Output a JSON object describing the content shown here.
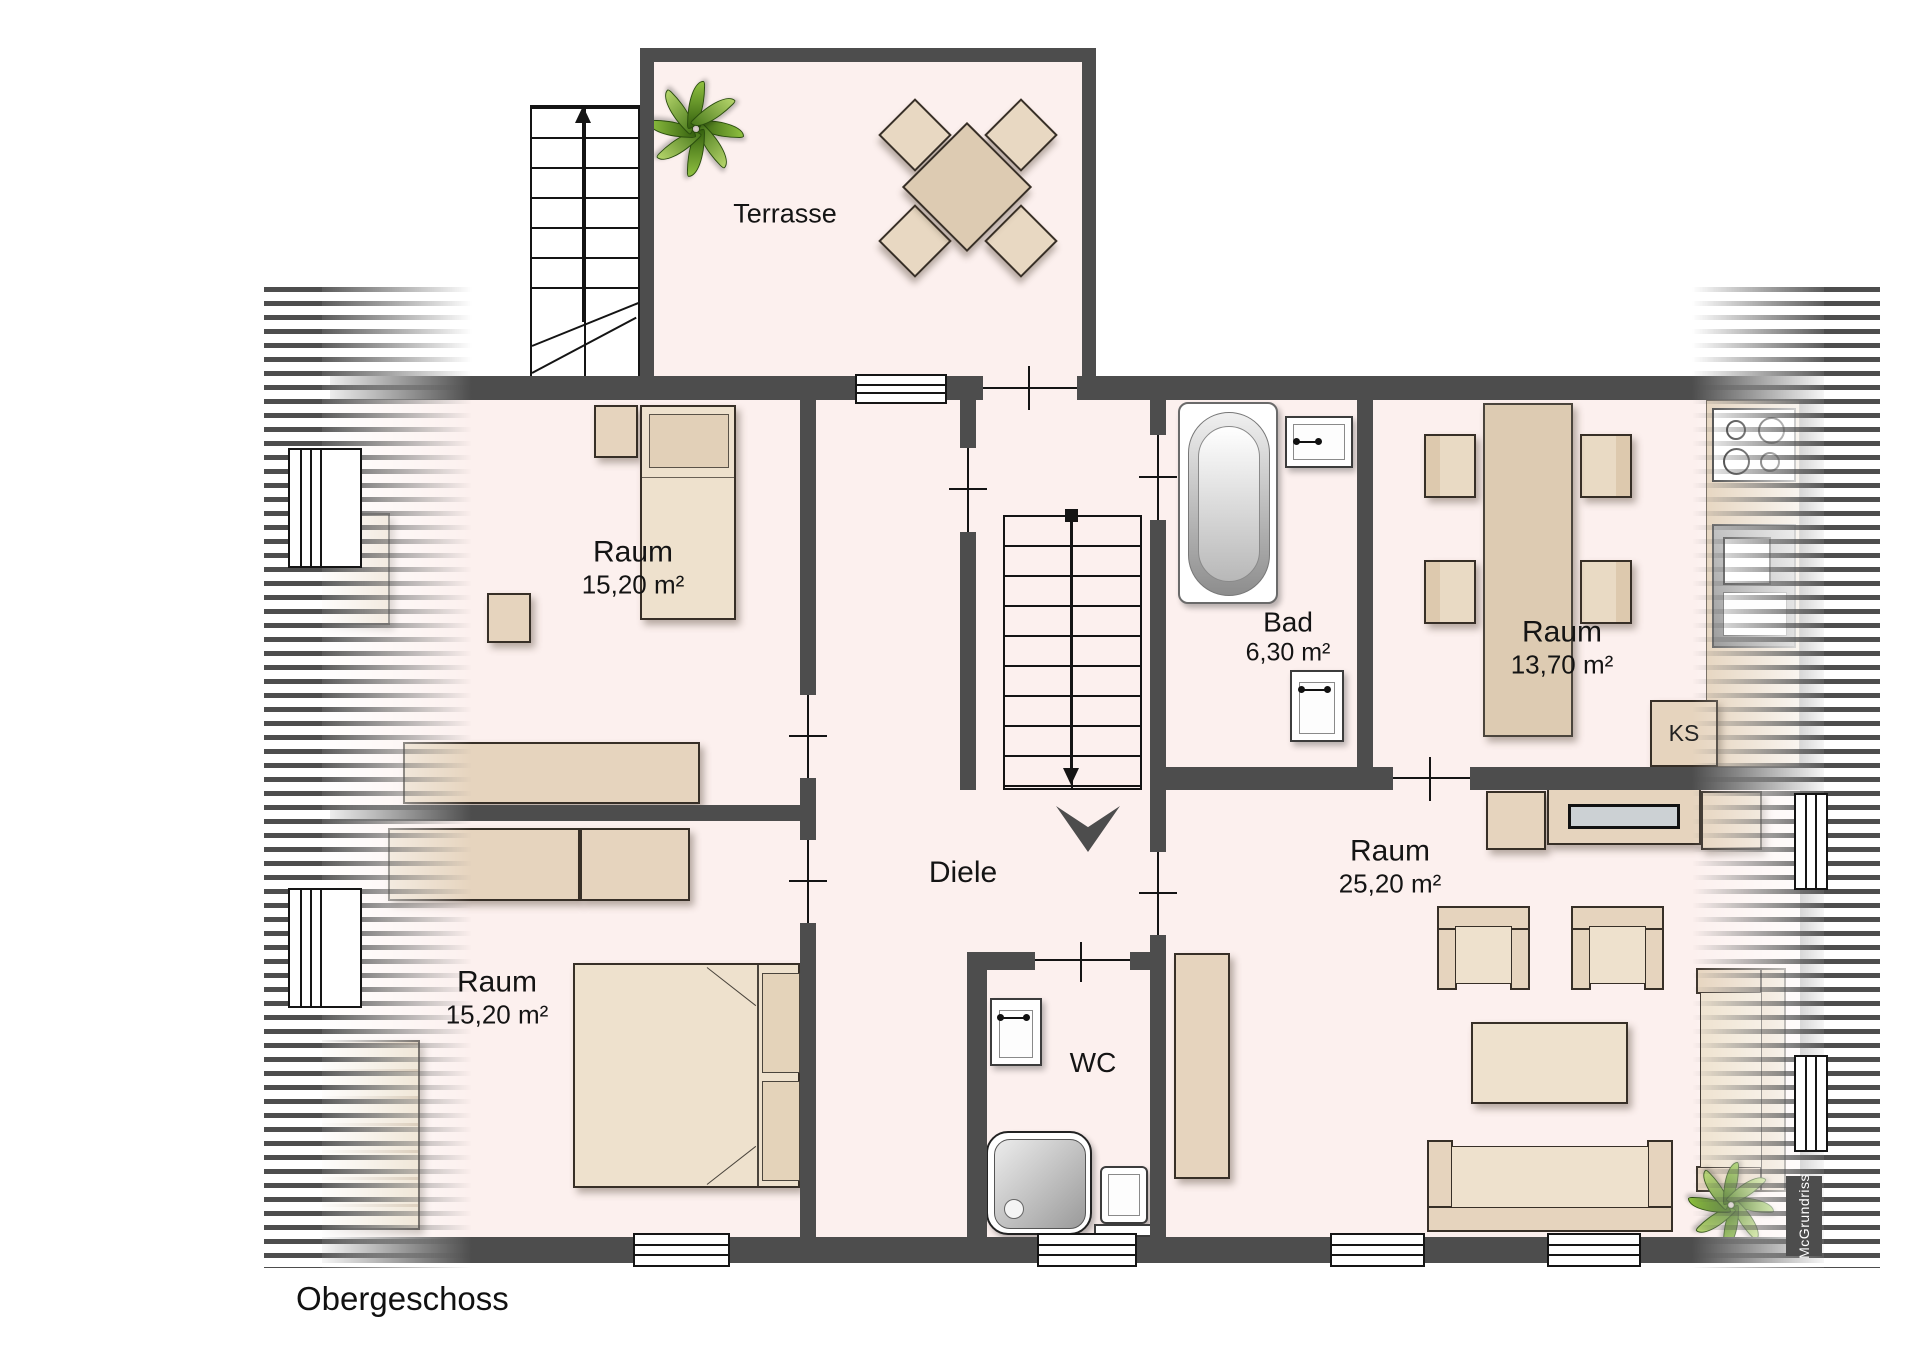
{
  "floor_plan": {
    "floor_label": "Obergeschoss",
    "watermark": "McGrundriss",
    "rooms": {
      "terrasse": {
        "name": "Terrasse"
      },
      "raum_top_left": {
        "name": "Raum",
        "area": "15,20 m²"
      },
      "raum_bottom_left": {
        "name": "Raum",
        "area": "15,20 m²"
      },
      "diele": {
        "name": "Diele"
      },
      "bad": {
        "name": "Bad",
        "area": "6,30 m²"
      },
      "raum_dining": {
        "name": "Raum",
        "area": "13,70 m²"
      },
      "raum_living": {
        "name": "Raum",
        "area": "25,20 m²"
      },
      "wc": {
        "name": "WC"
      }
    },
    "labels": {
      "fridge": "KS"
    },
    "colors": {
      "wall": "#4d4d4d",
      "floor": "#fcf0ee",
      "furniture": "#e6d4be",
      "furniture_light": "#eee1cd",
      "fixture_white": "#ffffff",
      "tv_screen": "#ccd1d4",
      "plant_green": "#8fc040",
      "hatch": "#4d4d4d",
      "text": "#141414"
    },
    "symbols": [
      "exterior-staircase",
      "interior-staircase",
      "stair-direction-arrow",
      "entrance-chevron",
      "bathtub",
      "shower",
      "toilet",
      "washbasin",
      "radiator",
      "stove",
      "kitchen-sink",
      "fridge",
      "dining-table",
      "dining-chair",
      "terrace-table",
      "terrace-chair",
      "bed-single",
      "bed-double",
      "pillow",
      "wardrobe",
      "dresser",
      "desk",
      "side-table",
      "sideboard",
      "tv-lowboard",
      "tv-screen",
      "armchair",
      "coffee-table",
      "sofa",
      "side-sofa",
      "cupboard",
      "plant",
      "window",
      "door-opening",
      "roof-slope-hatch"
    ]
  }
}
